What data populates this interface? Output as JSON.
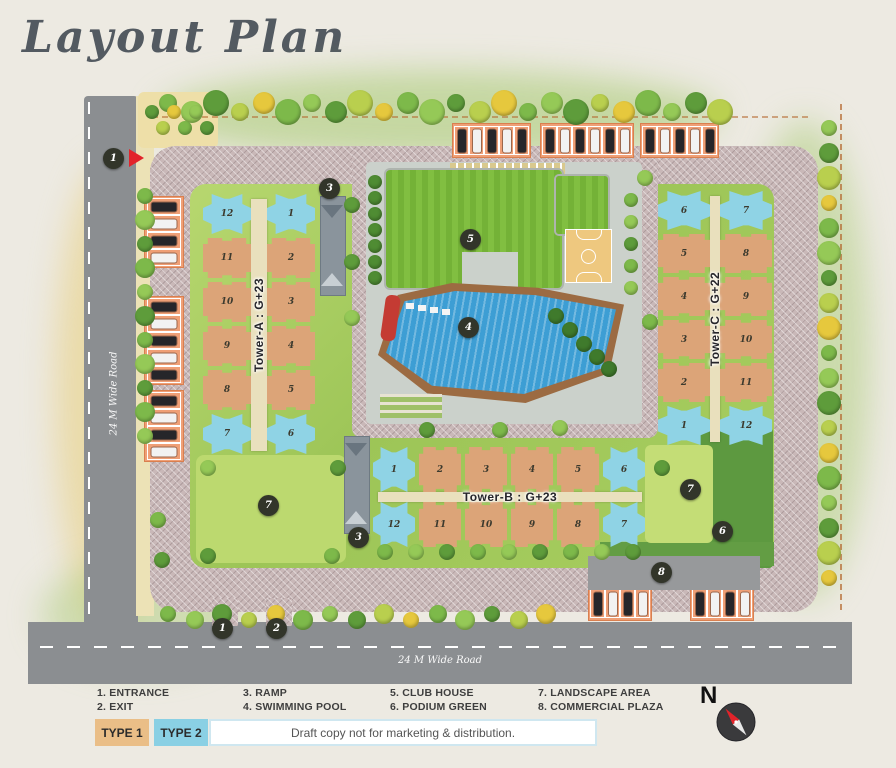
{
  "title": "Layout Plan",
  "roads": {
    "left_label": "24 M Wide Road",
    "bottom_label": "24 M Wide Road"
  },
  "towers": {
    "a": {
      "label": "Tower-A : G+23",
      "left_units": [
        "12",
        "11",
        "10",
        "9",
        "8",
        "7"
      ],
      "right_units": [
        "1",
        "2",
        "3",
        "4",
        "5",
        "6"
      ]
    },
    "b": {
      "label": "Tower-B : G+23",
      "top_units": [
        "1",
        "2",
        "3",
        "4",
        "5",
        "6"
      ],
      "bottom_units": [
        "12",
        "11",
        "10",
        "9",
        "8",
        "7"
      ]
    },
    "c": {
      "label": "Tower-C : G+22",
      "left_units": [
        "6",
        "5",
        "4",
        "3",
        "2",
        "1"
      ],
      "right_units": [
        "7",
        "8",
        "9",
        "10",
        "11",
        "12"
      ]
    }
  },
  "markers": [
    {
      "n": "1",
      "x": 113,
      "y": 158
    },
    {
      "n": "3",
      "x": 329,
      "y": 188
    },
    {
      "n": "5",
      "x": 470,
      "y": 239
    },
    {
      "n": "4",
      "x": 468,
      "y": 327
    },
    {
      "n": "7",
      "x": 268,
      "y": 505
    },
    {
      "n": "7",
      "x": 690,
      "y": 489
    },
    {
      "n": "6",
      "x": 722,
      "y": 531
    },
    {
      "n": "3",
      "x": 358,
      "y": 537
    },
    {
      "n": "1",
      "x": 222,
      "y": 628
    },
    {
      "n": "2",
      "x": 276,
      "y": 628
    },
    {
      "n": "8",
      "x": 661,
      "y": 572
    }
  ],
  "legend": [
    "1. ENTRANCE",
    "2. EXIT",
    "3. RAMP",
    "4. SWIMMING POOL",
    "5. CLUB HOUSE",
    "6. PODIUM GREEN",
    "7. LANDSCAPE AREA",
    "8. COMMERCIAL PLAZA"
  ],
  "types": [
    {
      "label": "TYPE 1",
      "color": "#eabe87"
    },
    {
      "label": "TYPE 2",
      "color": "#8ad0e4"
    }
  ],
  "draft_note": "Draft copy not for marketing & distribution.",
  "compass_label": "N",
  "colors": {
    "type1_unit": "#dca478",
    "type2_unit": "#8fd3e5",
    "pool": "#3d9ed4",
    "clubhouse_roof": "#76b43a",
    "public_road": "#8b8e91",
    "paver_road": "#c9b8b8",
    "marker_bg": "#32352a",
    "entrance_arrow": "#e2232a"
  }
}
